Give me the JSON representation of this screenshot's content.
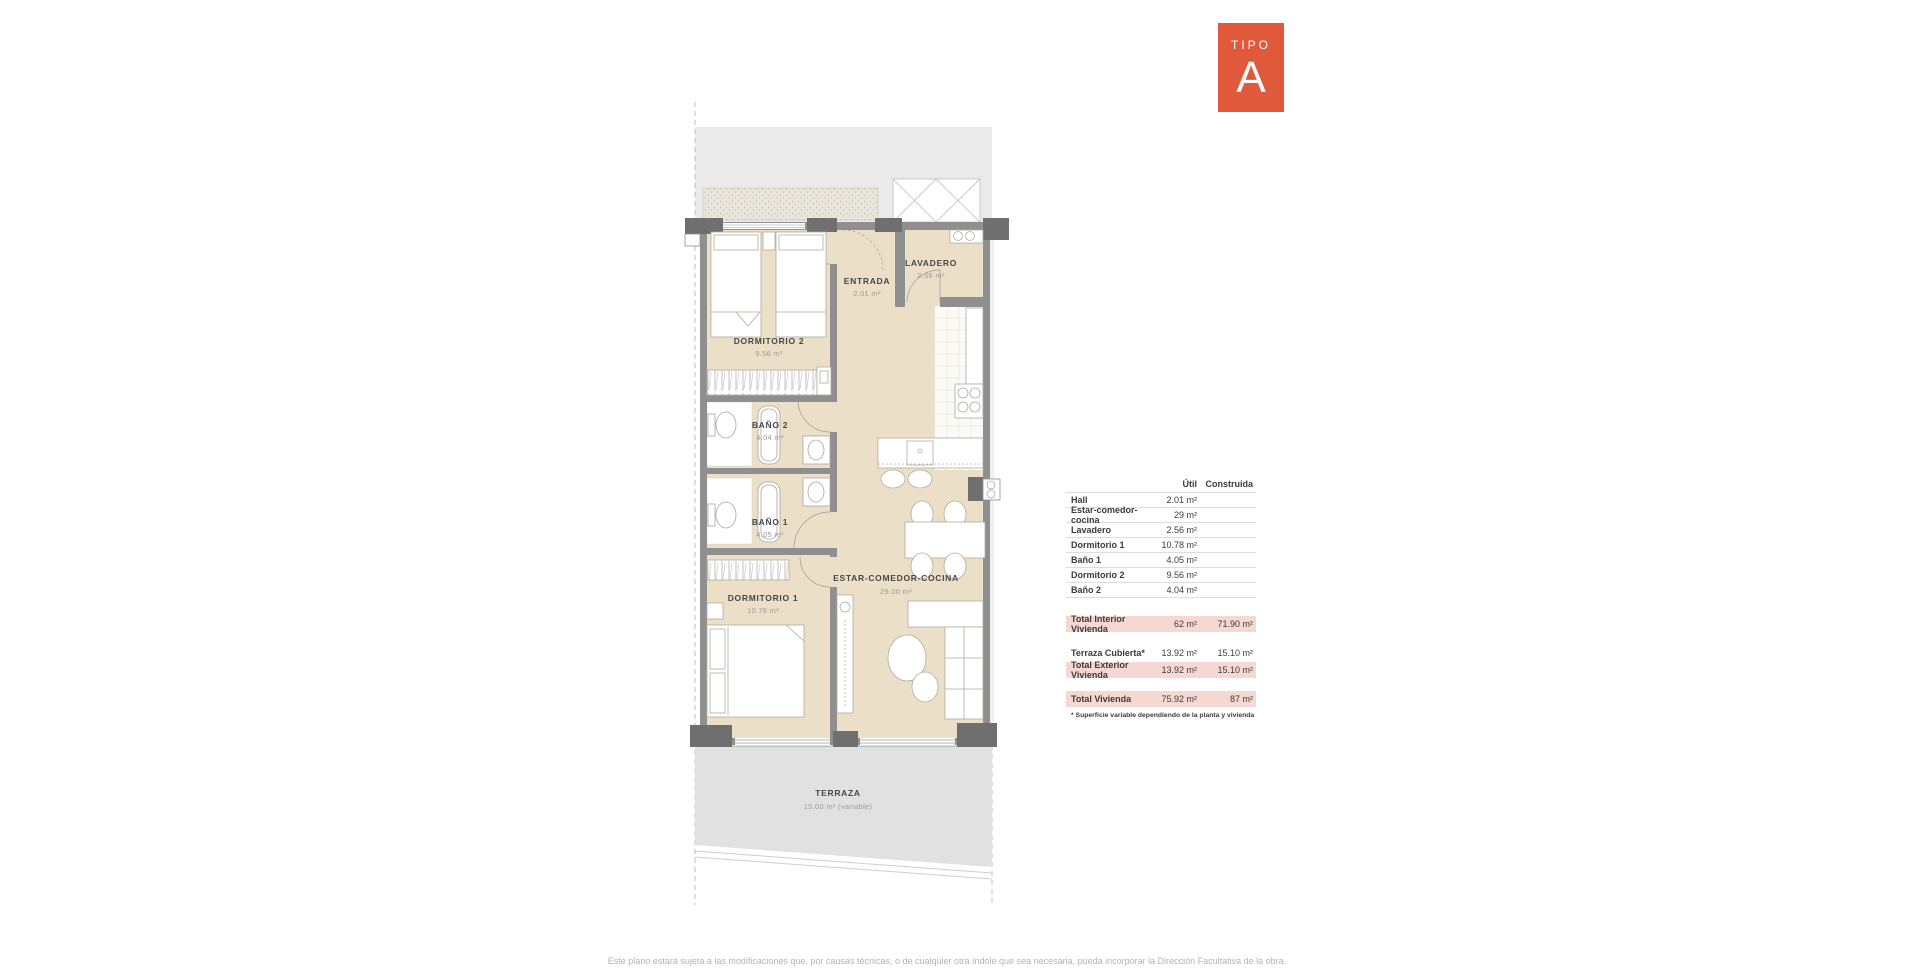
{
  "badge": {
    "tipo_label": "TIPO",
    "letter": "A",
    "color": "#e0593a"
  },
  "plan": {
    "rooms": [
      {
        "name": "DORMITORIO 2",
        "area": "9.56 m²"
      },
      {
        "name": "ENTRADA",
        "area": "2.01 m²"
      },
      {
        "name": "LAVADERO",
        "area": "2.56 m²"
      },
      {
        "name": "BAÑO 2",
        "area": "4.04 m²"
      },
      {
        "name": "BAÑO 1",
        "area": "4.05 m²"
      },
      {
        "name": "DORMITORIO 1",
        "area": "10.78 m²"
      },
      {
        "name": "ESTAR-COMEDOR-COCINA",
        "area": "29.00 m²"
      },
      {
        "name": "TERRAZA",
        "area": "15.00 m² (variable)"
      }
    ],
    "floor_color": "#ecdfc8",
    "wall_color": "#8f8f8f",
    "terrace_color": "#e1e1e1"
  },
  "table": {
    "headers": {
      "util": "Útil",
      "construida": "Construida"
    },
    "rows": [
      {
        "label": "Hall",
        "util": "2.01 m²",
        "construida": ""
      },
      {
        "label": "Estar-comedor-cocina",
        "util": "29 m²",
        "construida": ""
      },
      {
        "label": "Lavadero",
        "util": "2.56 m²",
        "construida": ""
      },
      {
        "label": "Dormitorio 1",
        "util": "10.78 m²",
        "construida": ""
      },
      {
        "label": "Baño 1",
        "util": "4.05 m²",
        "construida": ""
      },
      {
        "label": "Dormitorio 2",
        "util": "9.56 m²",
        "construida": ""
      },
      {
        "label": "Baño 2",
        "util": "4.04 m²",
        "construida": ""
      }
    ],
    "totals": [
      {
        "label": "Total Interior Vivienda",
        "util": "62 m²",
        "construida": "71.90 m²"
      },
      {
        "label": "Terraza Cubierta*",
        "util": "13.92 m²",
        "construida": "15.10 m²"
      },
      {
        "label": "Total Exterior Vivienda",
        "util": "13.92 m²",
        "construida": "15.10 m²"
      },
      {
        "label": "Total Vivienda",
        "util": "75.92 m²",
        "construida": "87 m²"
      }
    ],
    "footnote": "* Superficie variable dependiendo de la planta y vivienda",
    "highlight_color": "#f7d7d1"
  },
  "footer": {
    "disclaimer": "Este plano estará sujeta a las modificaciones que, por causas técnicas, o de cualquier otra índole que sea necesaria, pueda incorporar la Dirección Facultativa de la obra."
  }
}
